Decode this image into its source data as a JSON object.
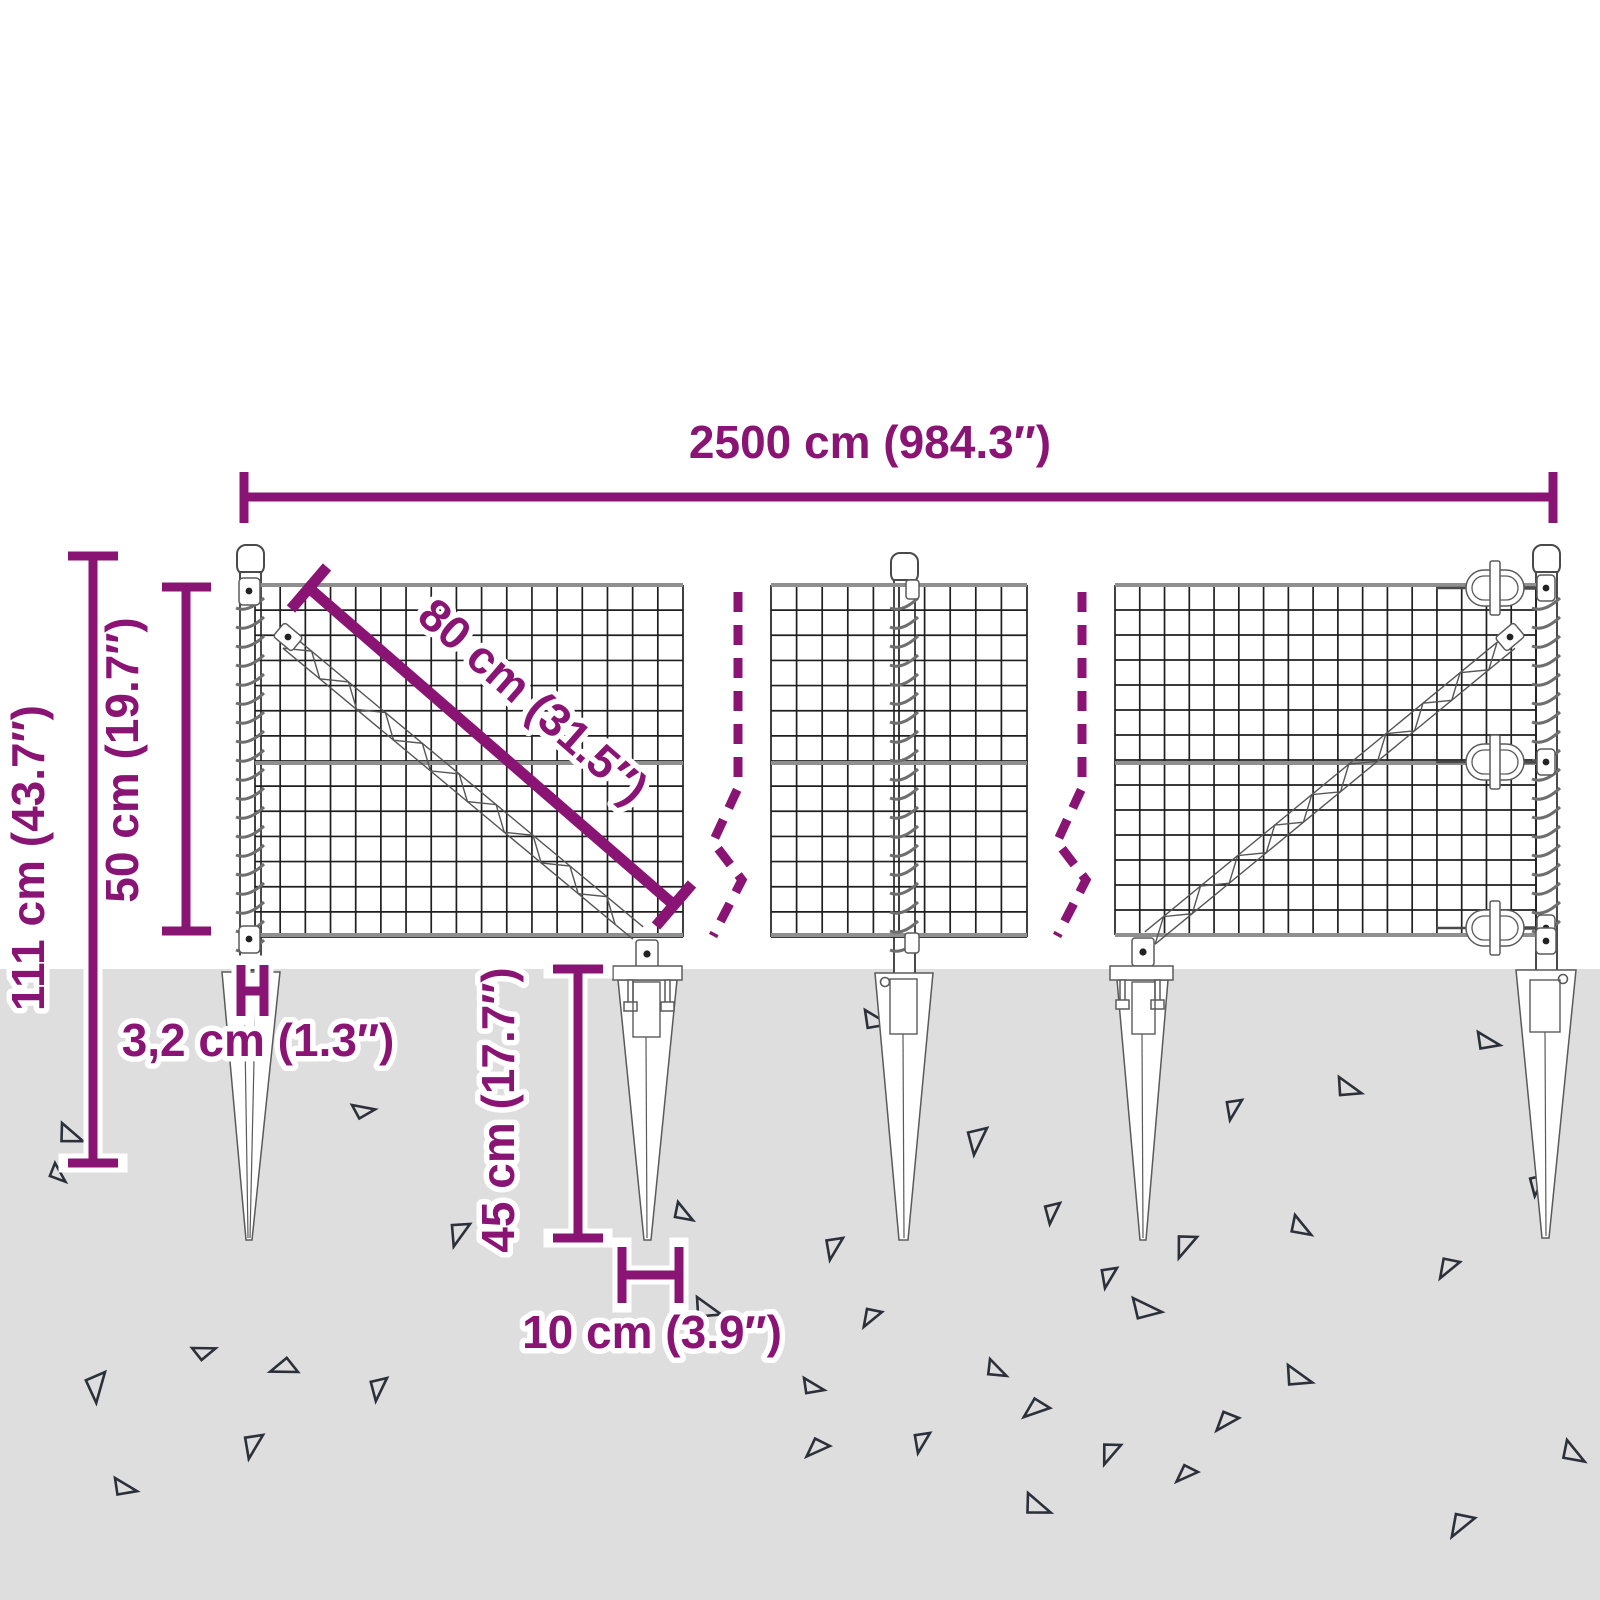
{
  "diagram_title": "wire-mesh-fence-with-ground-spikes-dimension-diagram",
  "colors": {
    "accent": "#8a1474",
    "ground": "#dedede",
    "mesh": "#1f1f1f",
    "wire_gray": "#8f8f8f",
    "steel_outline": "#4a4a4a",
    "triangle_outline": "#2b303a",
    "background": "#ffffff"
  },
  "labels": {
    "width_total": "2500 cm (984.3″)",
    "height_total": "111 cm (43.7″)",
    "mesh_height": "50 cm (19.7″)",
    "brace_diagonal": "80 cm (31.5″)",
    "post_width": "3,2 cm (1.3″)",
    "spike_length": "45 cm (17.7″)",
    "spike_top_width": "10 cm (3.9″)"
  },
  "ground": {
    "triangles": [
      [
        62,
        1123,
        20,
        26
      ],
      [
        352,
        1105,
        -10,
        22
      ],
      [
        105,
        1372,
        85,
        30
      ],
      [
        263,
        1435,
        100,
        26
      ],
      [
        115,
        1478,
        10,
        24
      ],
      [
        192,
        1348,
        -20,
        22
      ],
      [
        298,
        1372,
        160,
        26
      ],
      [
        387,
        1378,
        95,
        24
      ],
      [
        470,
        1224,
        105,
        26
      ],
      [
        678,
        1202,
        30,
        22
      ],
      [
        697,
        1297,
        15,
        28
      ],
      [
        843,
        1238,
        100,
        24
      ],
      [
        865,
        1010,
        10,
        26
      ],
      [
        987,
        1128,
        95,
        28
      ],
      [
        830,
        1446,
        135,
        24
      ],
      [
        882,
        1312,
        120,
        22
      ],
      [
        1133,
        1298,
        5,
        30
      ],
      [
        990,
        1359,
        25,
        22
      ],
      [
        804,
        1378,
        10,
        22
      ],
      [
        1050,
        1408,
        140,
        26
      ],
      [
        1288,
        1365,
        15,
        28
      ],
      [
        1239,
        1418,
        130,
        24
      ],
      [
        930,
        1433,
        100,
        22
      ],
      [
        1121,
        1445,
        110,
        24
      ],
      [
        1198,
        1472,
        135,
        22
      ],
      [
        1028,
        1493,
        20,
        28
      ],
      [
        1478,
        1032,
        10,
        24
      ],
      [
        1339,
        1077,
        15,
        26
      ],
      [
        1242,
        1100,
        100,
        22
      ],
      [
        1060,
        1203,
        95,
        22
      ],
      [
        1295,
        1215,
        30,
        24
      ],
      [
        1197,
        1237,
        110,
        26
      ],
      [
        1117,
        1268,
        100,
        22
      ],
      [
        1460,
        1262,
        120,
        24
      ],
      [
        1545,
        1175,
        95,
        22
      ],
      [
        1567,
        1440,
        30,
        26
      ],
      [
        1475,
        1518,
        120,
        28
      ],
      [
        55,
        1163,
        40,
        20
      ]
    ]
  }
}
